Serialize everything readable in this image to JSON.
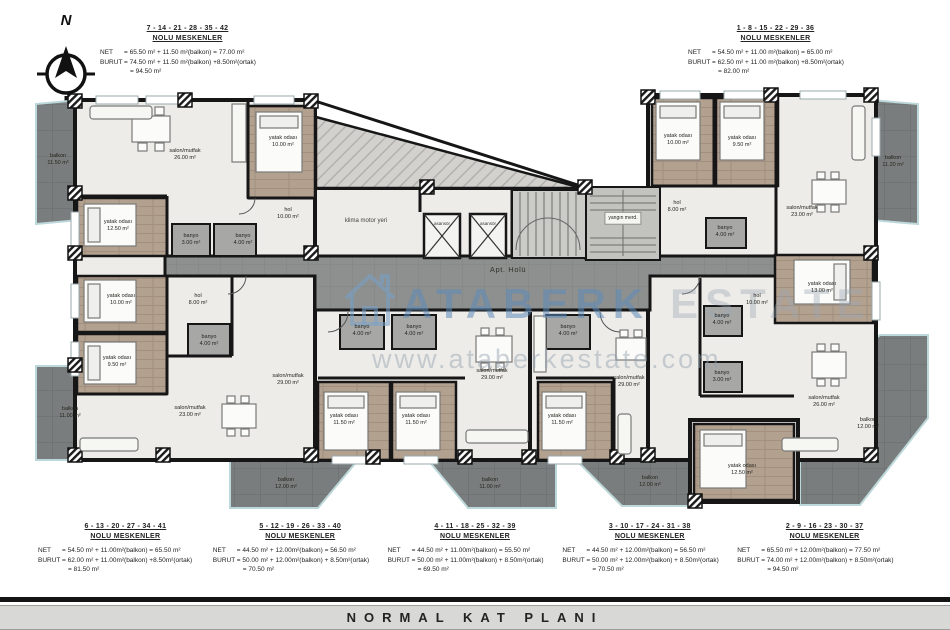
{
  "title_bar": {
    "title": "NORMAL KAT PLANI"
  },
  "compass": {
    "label": "N"
  },
  "watermark": {
    "brand_primary": "ATABERK",
    "brand_secondary": "ESTATE",
    "url": "www.ataberkestate.com",
    "logo_color": "#9fc0dc"
  },
  "block_labels": {
    "net_label": "NET",
    "burut_label": "BURUT"
  },
  "top_blocks": [
    {
      "units": "7 - 14 - 21 - 28 - 35 - 42",
      "subtitle": "NOLU MESKENLER",
      "net": "= 65.50 m² + 11.50 m²(balkon) = 77.00 m²",
      "burut": "= 74.50 m² + 11.50 m²(balkon) +8.50m²(ortak)",
      "burut2": "= 94.50 m²"
    },
    {
      "units": "1 - 8 - 15 - 22 - 29 - 36",
      "subtitle": "NOLU MESKENLER",
      "net": "= 54.50 m² + 11.00 m²(balkon) = 65.00 m²",
      "burut": "= 62.50 m² + 11.00 m²(balkon) +8.50m²(ortak)",
      "burut2": "= 82.00 m²"
    }
  ],
  "bottom_blocks": [
    {
      "units": "6 - 13 - 20 - 27 - 34 - 41",
      "subtitle": "NOLU MESKENLER",
      "net": "= 54.50 m² + 11.00m²(balkon) = 65.50 m²",
      "burut": "= 62.00 m² + 11.00m²(balkon) +8.50m²(ortak)",
      "burut2": "= 81.50 m²"
    },
    {
      "units": "5 - 12 - 19 - 26 - 33 - 40",
      "subtitle": "NOLU MESKENLER",
      "net": "= 44.50 m² + 12.00m²(balkon) = 56.50 m²",
      "burut": "= 50.00 m² + 12.00m²(balkon) + 8.50m²(ortak)",
      "burut2": "= 70.50 m²"
    },
    {
      "units": "4 - 11 - 18 - 25 - 32 - 39",
      "subtitle": "NOLU MESKENLER",
      "net": "= 44.50 m² + 11.00m²(balkon) = 55.50 m²",
      "burut": "= 50.00 m² + 11.00m²(balkon) + 8.50m²(ortak)",
      "burut2": "= 69.50 m²"
    },
    {
      "units": "3 - 10 - 17 - 24 - 31 - 38",
      "subtitle": "NOLU MESKENLER",
      "net": "= 44.50 m² + 12.00m²(balkon) = 56.50 m²",
      "burut": "= 50.00 m² + 12.00m²(balkon) + 8.50m²(ortak)",
      "burut2": "= 70.50 m²"
    },
    {
      "units": "2 - 9 - 16 - 23 - 30 - 37",
      "subtitle": "NOLU MESKENLER",
      "net": "= 65.50 m² + 12.00m²(balkon) = 77.50 m²",
      "burut": "= 74.00 m² + 12.00m²(balkon) + 8.50m²(ortak)",
      "burut2": "= 94.50 m²"
    }
  ],
  "plan": {
    "labels": [
      {
        "t": "salon/mutfak",
        "a": "26.00 m²",
        "x": 185,
        "y": 155
      },
      {
        "t": "yatak odası",
        "a": "10.00 m²",
        "x": 283,
        "y": 142
      },
      {
        "t": "hol",
        "a": "10.00 m²",
        "x": 288,
        "y": 214
      },
      {
        "t": "yatak odası",
        "a": "12.50 m²",
        "x": 118,
        "y": 226
      },
      {
        "t": "banyo",
        "a": "3.00 m²",
        "x": 191,
        "y": 240
      },
      {
        "t": "banyo",
        "a": "4.00 m²",
        "x": 243,
        "y": 240
      },
      {
        "t": "yatak odası",
        "a": "10.00 m²",
        "x": 121,
        "y": 300
      },
      {
        "t": "yatak odası",
        "a": "9.50 m²",
        "x": 117,
        "y": 362
      },
      {
        "t": "hol",
        "a": "8.00 m²",
        "x": 198,
        "y": 300
      },
      {
        "t": "banyo",
        "a": "4.00 m²",
        "x": 209,
        "y": 341
      },
      {
        "t": "salon/mutfak",
        "a": "23.00 m²",
        "x": 190,
        "y": 412
      },
      {
        "t": "salon/mutfak",
        "a": "29.00 m²",
        "x": 288,
        "y": 380
      },
      {
        "t": "banyo",
        "a": "4.00 m²",
        "x": 362,
        "y": 331
      },
      {
        "t": "banyo",
        "a": "4.00 m²",
        "x": 414,
        "y": 331
      },
      {
        "t": "yatak odası",
        "a": "11.50 m²",
        "x": 344,
        "y": 420
      },
      {
        "t": "yatak odası",
        "a": "11.50 m²",
        "x": 416,
        "y": 420
      },
      {
        "t": "salon/mutfak",
        "a": "29.00 m²",
        "x": 492,
        "y": 375
      },
      {
        "t": "banyo",
        "a": "4.00 m²",
        "x": 568,
        "y": 331
      },
      {
        "t": "yatak odası",
        "a": "11.50 m²",
        "x": 562,
        "y": 420
      },
      {
        "t": "salon/mutfak",
        "a": "29.00 m²",
        "x": 629,
        "y": 382
      },
      {
        "t": "yatak odası",
        "a": "10.00 m²",
        "x": 678,
        "y": 140
      },
      {
        "t": "yatak odası",
        "a": "9.50 m²",
        "x": 742,
        "y": 142
      },
      {
        "t": "hol",
        "a": "8.00 m²",
        "x": 677,
        "y": 207
      },
      {
        "t": "banyo",
        "a": "4.00 m²",
        "x": 725,
        "y": 232
      },
      {
        "t": "salon/mutfak",
        "a": "23.00 m²",
        "x": 802,
        "y": 212
      },
      {
        "t": "hol",
        "a": "10.00 m²",
        "x": 757,
        "y": 300
      },
      {
        "t": "banyo",
        "a": "4.00 m²",
        "x": 722,
        "y": 320
      },
      {
        "t": "banyo",
        "a": "3.00 m²",
        "x": 722,
        "y": 377
      },
      {
        "t": "yatak odası",
        "a": "13.00 m²",
        "x": 822,
        "y": 288
      },
      {
        "t": "salon/mutfak",
        "a": "26.00 m²",
        "x": 824,
        "y": 402
      },
      {
        "t": "yatak odası",
        "a": "12.50 m²",
        "x": 742,
        "y": 470
      },
      {
        "t": "balkon",
        "a": "11.50 m²",
        "x": 58,
        "y": 160
      },
      {
        "t": "balkon",
        "a": "11.00 m²",
        "x": 70,
        "y": 413
      },
      {
        "t": "balkon",
        "a": "12.00 m²",
        "x": 286,
        "y": 484
      },
      {
        "t": "balkon",
        "a": "11.00 m²",
        "x": 490,
        "y": 484
      },
      {
        "t": "balkon",
        "a": "12.00 m²",
        "x": 650,
        "y": 482
      },
      {
        "t": "balkon",
        "a": "12.00 m²",
        "x": 868,
        "y": 424
      },
      {
        "t": "balkon",
        "a": "11.20 m²",
        "x": 893,
        "y": 162
      },
      {
        "t": "klima motor yeri",
        "a": "",
        "x": 366,
        "y": 222,
        "cls": "wide"
      },
      {
        "t": "Apt. Holü",
        "a": "",
        "x": 508,
        "y": 270,
        "cls": "hall"
      },
      {
        "t": "asansör",
        "a": "",
        "x": 442,
        "y": 224,
        "cls": "tiny"
      },
      {
        "t": "asansör",
        "a": "",
        "x": 488,
        "y": 224,
        "cls": "tiny"
      },
      {
        "t": "yangın merd.",
        "a": "",
        "x": 623,
        "y": 218,
        "cls": "boxed"
      }
    ]
  }
}
